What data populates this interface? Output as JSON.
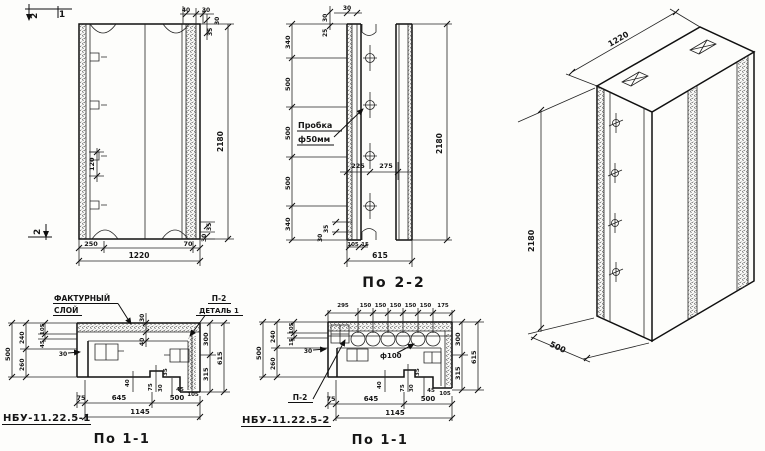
{
  "doc_type": "precast concrete wall panel working drawing",
  "colors": {
    "ink": "#161616",
    "paper": "#fdfdfb"
  },
  "elevation": {
    "mark_top_2": "2",
    "mark_top_1": "1",
    "mark_bottom_2": "2",
    "dims": {
      "t40": "40",
      "t30": "30",
      "r35": "35",
      "r30": "30",
      "l120": "120",
      "h2180": "2180",
      "b250": "250",
      "b70": "70",
      "b1220": "1220",
      "br30": "30",
      "br35": "35"
    }
  },
  "section22": {
    "label": "По 2-2",
    "plug_callout_line1": "Пробка",
    "plug_callout_line2": "ф50мм",
    "dims": {
      "t30": "30",
      "l30": "30",
      "l25": "25",
      "v340t": "340",
      "v500a": "500",
      "v500b": "500",
      "v500c": "500",
      "v340b": "340",
      "h225": "225",
      "h275": "275",
      "h2180": "2180",
      "b35": "35",
      "b30": "30",
      "b105": "105",
      "b15": "15",
      "b615": "615"
    }
  },
  "iso": {
    "dims": {
      "width": "1220",
      "height": "2180",
      "depth": "500"
    }
  },
  "sec11a": {
    "label": "По 1-1",
    "part_code": "НБУ-11.22.5-1",
    "facing_callout_line1": "ФАКТУРНЫЙ",
    "facing_callout_line2": "СЛОЙ",
    "detail_ref_line1": "П-2",
    "detail_ref_line2": "ДЕТАЛЬ 1",
    "dims": {
      "t30": "30",
      "t40": "40",
      "l500": "500",
      "l240": "240",
      "l260": "260",
      "l105": "105",
      "l45": "45",
      "l30": "30",
      "r300": "300",
      "r315": "315",
      "r615": "615",
      "i40": "40",
      "i75": "75",
      "i35": "35",
      "i30": "30",
      "i45": "45",
      "i105": "105",
      "b75": "75",
      "b645": "645",
      "b500": "500",
      "b1145": "1145"
    }
  },
  "sec11b": {
    "label": "По 1-1",
    "part_code": "НБУ-11.22.5-2",
    "detail_ref": "П-2",
    "hole_label": "ф100",
    "dims": {
      "t295": "295",
      "t150": "150",
      "t175": "175",
      "l500": "500",
      "l240": "240",
      "l260": "260",
      "l105": "105",
      "l15": "15",
      "l30": "30",
      "r300": "300",
      "r315": "315",
      "r615": "615",
      "i40": "40",
      "i75": "75",
      "i35": "35",
      "i30": "30",
      "i45": "45",
      "i105": "105",
      "b75": "75",
      "b645": "645",
      "b500": "500",
      "b1145": "1145"
    }
  }
}
